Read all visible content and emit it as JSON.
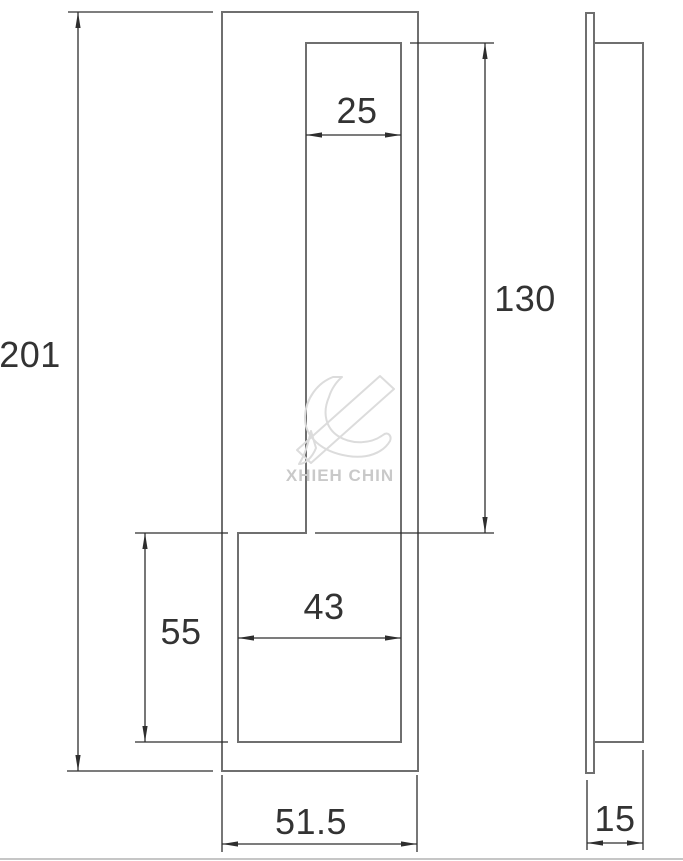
{
  "drawing": {
    "type": "technical-drawing",
    "views": {
      "front_view": "flush pull plate with upper slot and lower recess",
      "side_view": "plate profile with recessed body"
    },
    "dimensions": {
      "overall_height": "201",
      "slot_width": "25",
      "slot_height": "130",
      "lower_recess_height": "55",
      "lower_recess_width": "43",
      "overall_width": "51.5",
      "depth": "15"
    },
    "watermark": {
      "text": "XHIEH CHIN",
      "logo": "stylized-x-brush-logo"
    },
    "colors": {
      "outline": "#6f6f6f",
      "dimension_line": "#2e2e2e",
      "dimension_text": "#333333",
      "watermark": "#d6d6d6",
      "page_border": "#c6c6c6"
    }
  }
}
